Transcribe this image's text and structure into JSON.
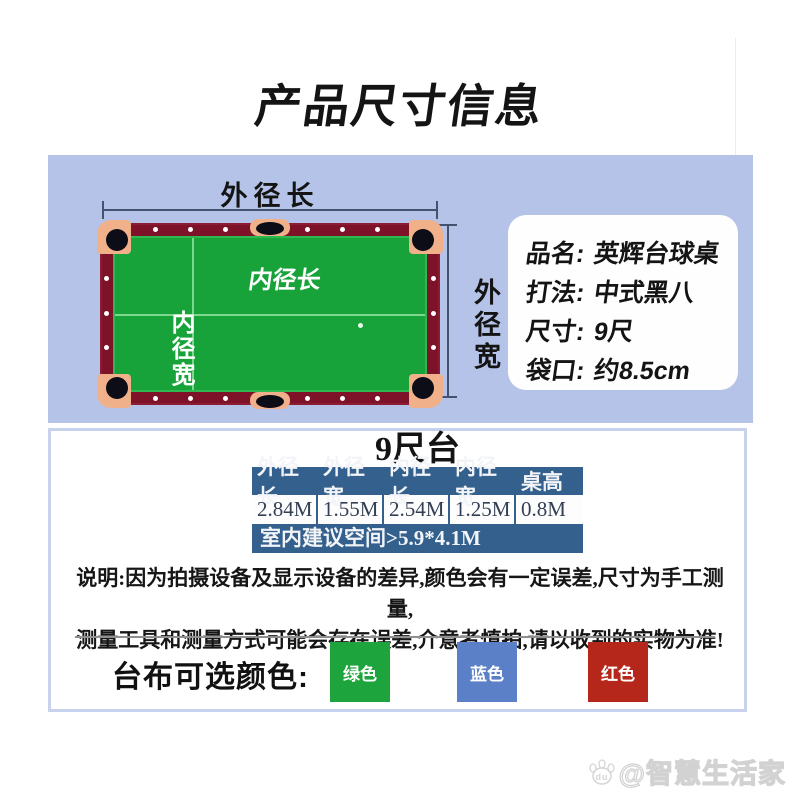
{
  "page": {
    "title": "产品尺寸信息"
  },
  "diagram": {
    "outer_length_label": "外径长",
    "outer_width_label": "外径宽",
    "inner_length_label": "内径长",
    "inner_width_label": "内径宽"
  },
  "info_card": {
    "rows": [
      {
        "label": "品名:",
        "value": "英辉台球桌"
      },
      {
        "label": "打法:",
        "value": "中式黑八"
      },
      {
        "label": "尺寸:",
        "value": "9尺"
      },
      {
        "label": "袋口:",
        "value": "约8.5cm"
      }
    ]
  },
  "spec_table": {
    "title": "9尺台",
    "headers": [
      "外径长",
      "外径宽",
      "内径长",
      "内径宽",
      "桌高"
    ],
    "values": [
      "2.84M",
      "1.55M",
      "2.54M",
      "1.25M",
      "0.8M"
    ],
    "footer": "室内建议空间>5.9*4.1M"
  },
  "notice": {
    "line1": "说明:因为拍摄设备及显示设备的差异,颜色会有一定误差,尺寸为手工测量,",
    "line2": "测量工具和测量方式可能会存在误差,介意者慎拍,请以收到的实物为准!"
  },
  "cloth_colors": {
    "label": "台布可选颜色:",
    "options": [
      {
        "name": "绿色",
        "hex": "#1ea43c"
      },
      {
        "name": "蓝色",
        "hex": "#5b80c8"
      },
      {
        "name": "红色",
        "hex": "#b4271a"
      }
    ]
  },
  "watermark": {
    "text": "@智慧生活家",
    "icon_text": "du"
  },
  "colors": {
    "panel_blue": "#b4c3e7",
    "table_header_blue": "#33608d",
    "rail_maroon": "#7d1228",
    "felt_green": "#17a33a",
    "pocket_corner_salmon": "#f0b08a",
    "content_border": "#c9d2ec"
  }
}
